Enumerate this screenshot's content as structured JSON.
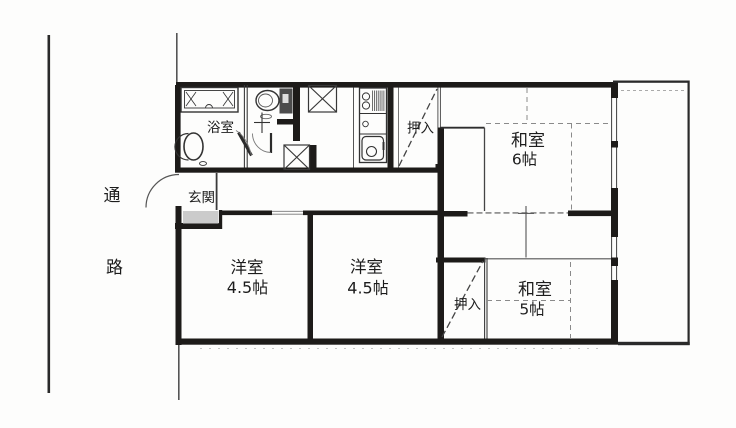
{
  "document": {
    "kind": "scanned-apartment-floor-plan"
  },
  "site": {
    "passage_chars": [
      "通",
      "路"
    ]
  },
  "labels": {
    "bathroom": "浴室",
    "entrance": "玄関",
    "closet_upper": "押入",
    "closet_lower": "押入",
    "washitsu_6": {
      "name": "和室",
      "size": "6帖"
    },
    "washitsu_5": {
      "name": "和室",
      "size": "5帖"
    },
    "youshitsu_left": {
      "name": "洋室",
      "size": "4.5帖"
    },
    "youshitsu_center": {
      "name": "洋室",
      "size": "4.5帖"
    }
  },
  "colors": {
    "wall": "#1d1b19",
    "paper": "#fdfdfc",
    "entrance_step": "#cbcbcb",
    "thin_line": "#444444",
    "tatami_line": "#8a8a8a",
    "text": "#1c1c1c"
  }
}
